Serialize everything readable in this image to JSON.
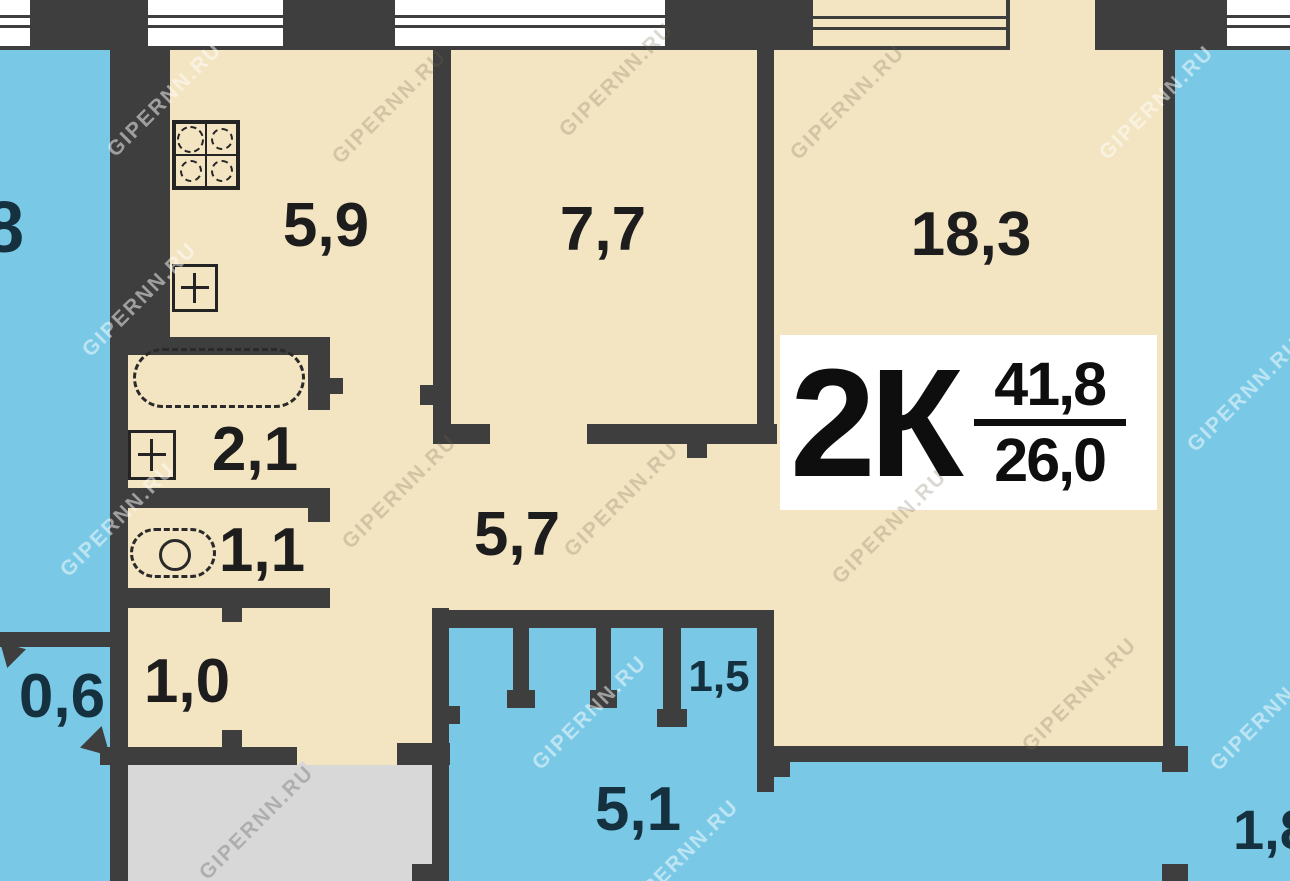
{
  "badge": {
    "type": "2К",
    "total_area": "41,8",
    "living_area": "26,0"
  },
  "rooms": {
    "kitchen": "5,9",
    "room_small": "7,7",
    "room_large": "18,3",
    "bathroom": "2,1",
    "toilet": "1,1",
    "hallway": "5,7",
    "entry": "1,0",
    "neighbor_balcony": "0,6",
    "balcony_closet": "1,5",
    "balcony": "5,1",
    "neighbor_right": "1,8",
    "neighbor_left": "8"
  },
  "watermark": "GIPERNN.RU",
  "colors": {
    "wall": "#3e3e3e",
    "interior": "#f3e5c2",
    "outside": "#79c9e6",
    "stairwell": "#d8d8d8",
    "window": "#ffffff",
    "label_dark": "#1d1d1d",
    "label_navy": "#15303e",
    "badge_bg": "#ffffff"
  },
  "fixtures": {
    "stove": "stove-icon",
    "kitchen_sink": "sink-icon",
    "bathtub": "bathtub-icon",
    "bath_sink": "sink-icon",
    "toilet": "toilet-icon"
  }
}
